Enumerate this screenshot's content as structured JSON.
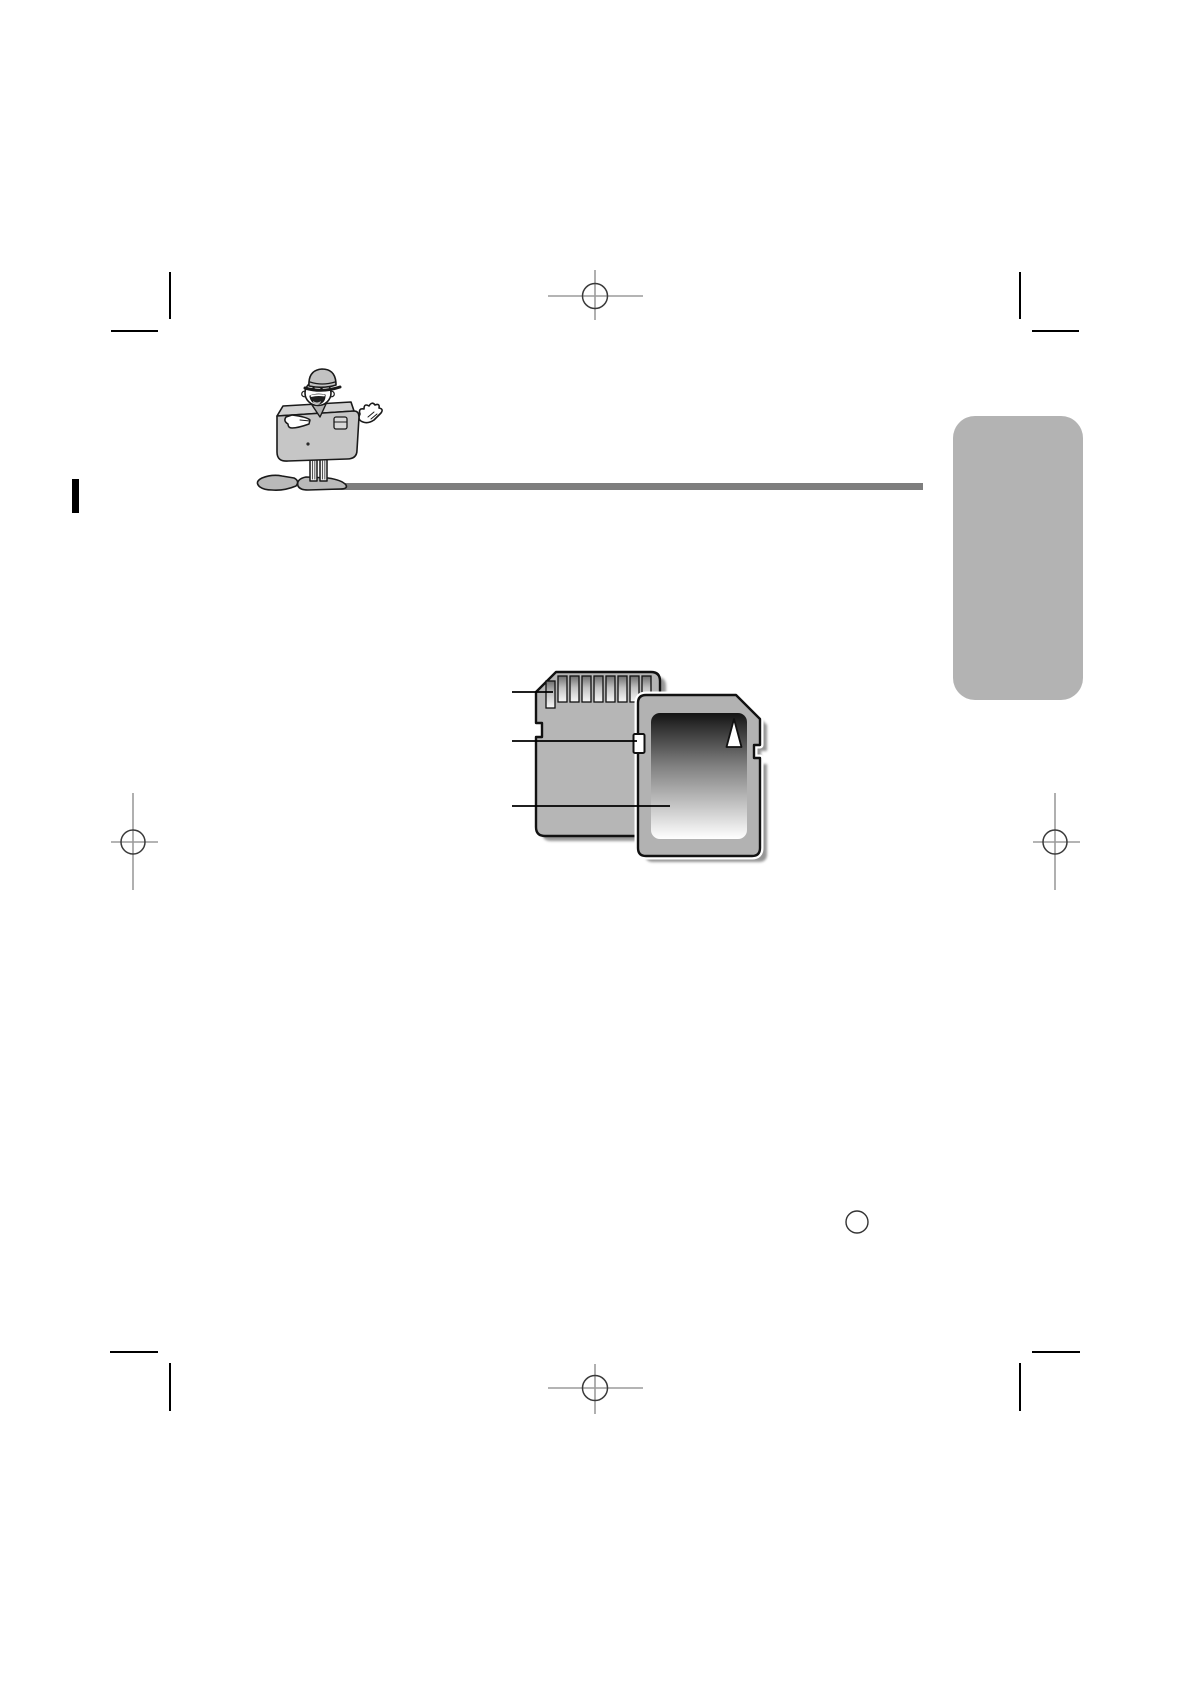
{
  "page": {
    "width_px": 1190,
    "height_px": 1684,
    "background": "#ffffff",
    "kind": "camera-manual-prepress-page-no-text"
  },
  "colors": {
    "page_bg": "#ffffff",
    "divider": "#7e7e7e",
    "side_tab": "#b3b3b3",
    "spine_mark": "#000000",
    "crop_mark": "#000000",
    "reg_line": "#9c9c9c",
    "reg_circle": "#3a3a3a",
    "page_circle": "#333333",
    "card_back_fill": "#b6b6b6",
    "card_front_fill": "#b2b2b2",
    "card_outline": "#111111",
    "card_shadow": "#969696",
    "pin_top": "#6e6e6e",
    "pin_mid": "#c2c2c2",
    "pin_bottom": "#f8f8f8",
    "label_top": "#141414",
    "label_mid": "#808080",
    "label_bottom": "#ffffff",
    "callout_line": "#000000",
    "mascot_body": "#c6c6c6",
    "mascot_top_face": "#d2d2d2",
    "mascot_hat": "#c2c2c2",
    "mascot_shoe": "#b9b9b9",
    "mascot_outline": "#1a1a1a"
  },
  "header": {
    "mascot_icon": "camera-mascot-character-icon",
    "divider_rule": "gray-horizontal-rule",
    "side_tab": "gray-rounded-section-tab"
  },
  "figure": {
    "name": "sd-memory-card-diagram",
    "cards": [
      {
        "name": "sd-card-rear-view"
      },
      {
        "name": "sd-card-front-view",
        "detail": "up-arrow-on-label"
      }
    ],
    "parts": [
      {
        "name": "contact-pins",
        "callout": true
      },
      {
        "name": "write-protect-switch",
        "callout": true
      },
      {
        "name": "card-label",
        "callout": true
      }
    ],
    "callout_count": 3
  },
  "print_marks": {
    "corner_crop_marks": [
      "top-left",
      "top-right",
      "bottom-left",
      "bottom-right"
    ],
    "registration_targets": [
      "top-center",
      "left-middle",
      "right-middle",
      "bottom-center"
    ],
    "spine_mark": "solid-black-bar-left-edge",
    "page_number_circle": "outlined-circle-bottom-right"
  }
}
